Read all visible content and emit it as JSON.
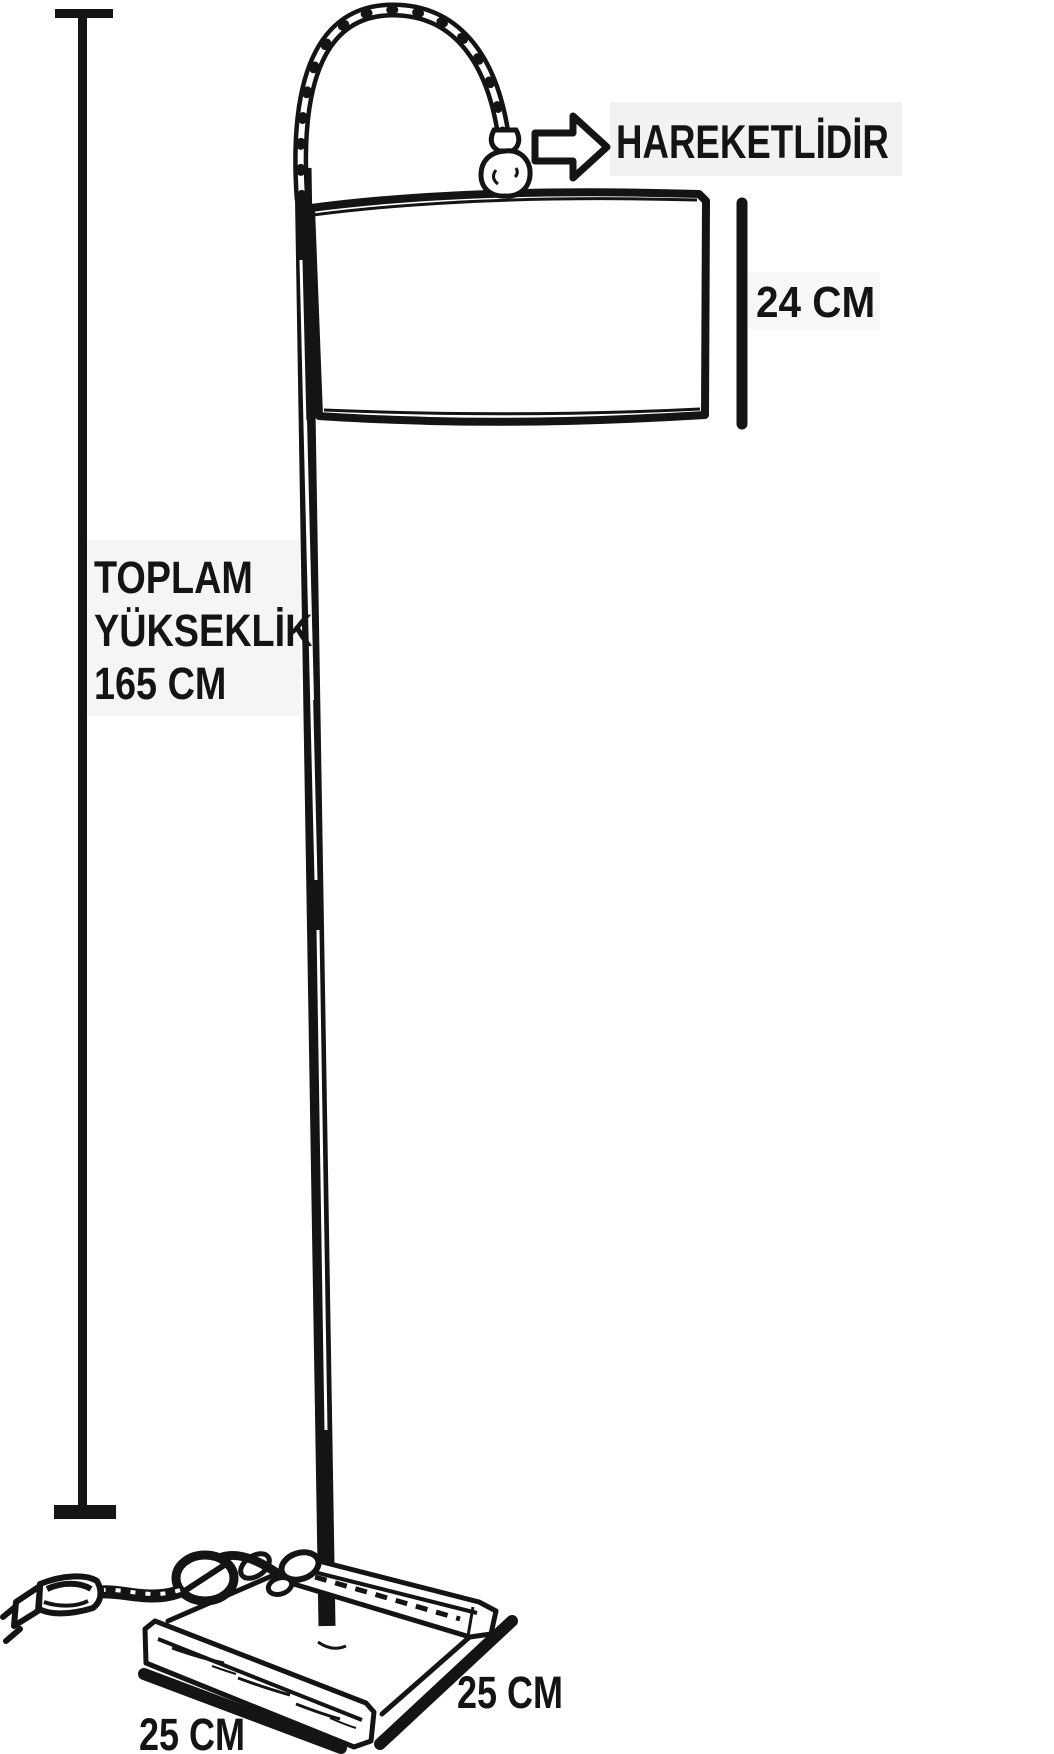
{
  "page": {
    "type": "product-dimension-diagram",
    "subject": "arched floor lamp line drawing",
    "ink_color": "#141414",
    "paper_color": "#ffffff",
    "tint_color": "#f2f2f2"
  },
  "labels": {
    "movable": "HAREKETLİDİR",
    "shade_height": "24 CM",
    "total_height": {
      "line1": "TOPLAM",
      "line2": "YÜKSEKLİK",
      "line3": "165 CM"
    },
    "base_front": "25 CM",
    "base_side": "25 CM"
  },
  "icons": {
    "movable_arrow": "right-block-arrow"
  }
}
